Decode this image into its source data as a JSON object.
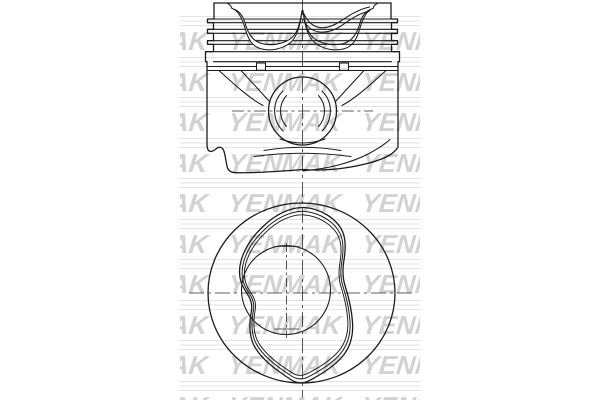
{
  "page": {
    "background_color": "#ffffff",
    "content": "technical line drawing of an engine piston, side cross-section above and crown top view below"
  },
  "drawing": {
    "line_color": "#1c1c1c",
    "centerline_color": "#2b2b2b"
  },
  "watermark": {
    "text": "YENMAK",
    "row_text": "YENMAK YENMAK YENMAK",
    "text_color": "#d2d2d2",
    "line_color": "#e3e3e3"
  }
}
